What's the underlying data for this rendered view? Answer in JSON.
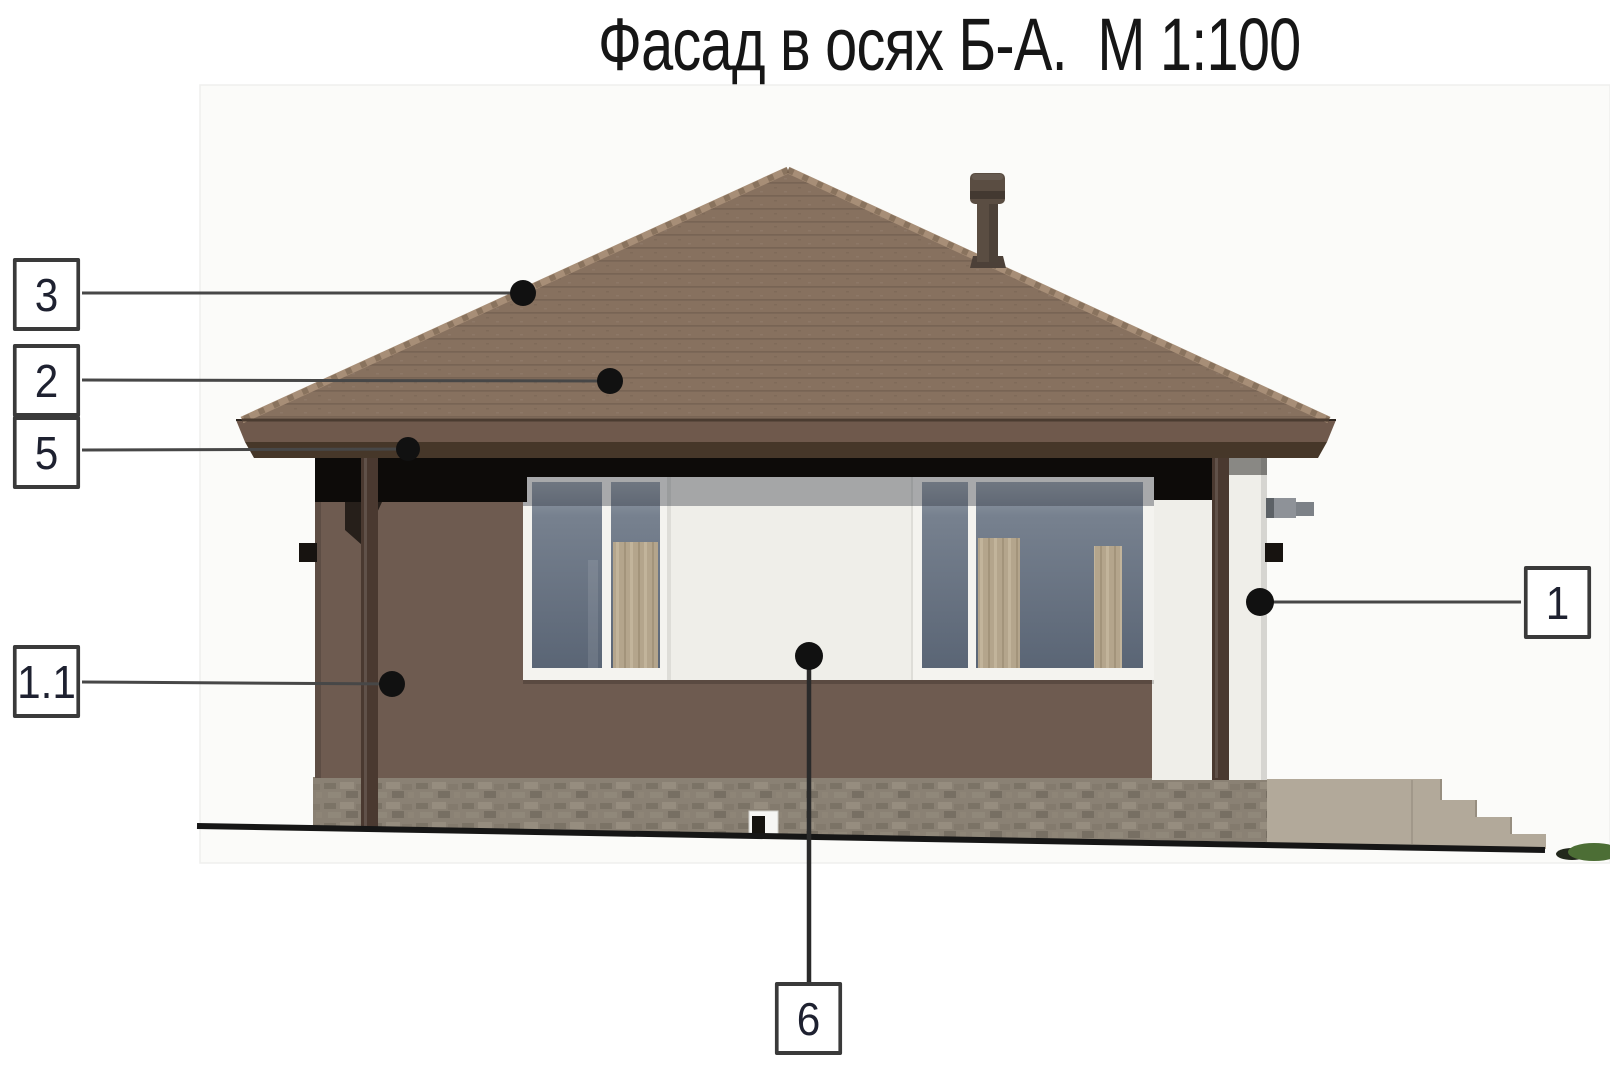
{
  "title": "Фасад в осях Б-А.  М 1:100",
  "callouts": [
    {
      "label": "3"
    },
    {
      "label": "2"
    },
    {
      "label": "5"
    },
    {
      "label": "1.1"
    },
    {
      "label": "1"
    },
    {
      "label": "6"
    }
  ],
  "colors": {
    "roof": "#87715f",
    "roof-edge": "#a78e77",
    "fascia": "#6f594c",
    "fascia-dark": "#463729",
    "eave-shadow": "#0d0b09",
    "wall": "#6e5b50",
    "wall-white": "#efeee9",
    "glass-dark": "#5a6575",
    "glass-light": "#99a1ac",
    "curtain": "#b6a78e",
    "frame-white": "#f4f3ef",
    "foundation": "#8a8174",
    "porch": "#b2a99a",
    "pipe": "#4a3930",
    "chimney": "#5a4d42",
    "ground": "#161616",
    "grass": "#4c6e35",
    "leader-line": "#474747",
    "leader-dot": "#111111",
    "box-border": "#3a3a3a",
    "box-text": "#1e2130"
  }
}
